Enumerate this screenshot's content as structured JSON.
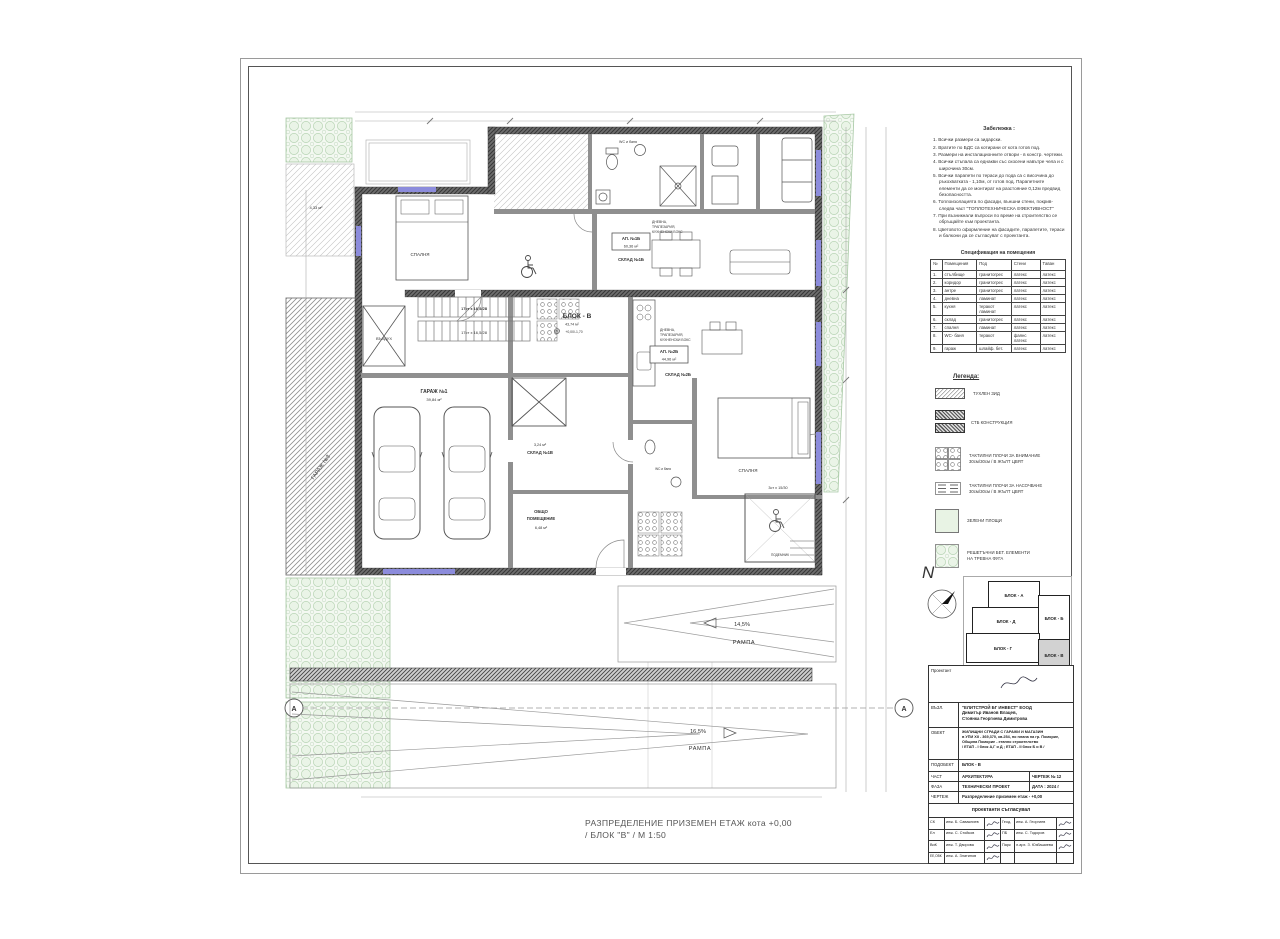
{
  "colors": {
    "wall_dark": "#5a5a5a",
    "window_blue": "#8c8cdc",
    "green_area": "#e8f3e4",
    "paper": "#ffffff"
  },
  "notes": {
    "title": "Забележка :",
    "items": [
      "1. Всички размери са зидарски.",
      "2. Вратите по БДС са котирани от кота готов под.",
      "3. Размери на инсталационните отвори - в констр. чертежи.",
      "4. Всички стъпала са еднакви със скосени навътре чела и с широчина 30см.",
      "5. Всички парапети по тераси до пода са с височина до ръкохватката - 1,10м, от готов под. Парапетните елементи да се монтират на разстояние 0,12м предвид безопасността.",
      "6. Топлоизолацията по фасади, външни стени, покрив- следва част \"ТОПЛОТЕХНИЧЕСКА ЕФЕКТИВНОСТ\"",
      "7. При възникнали въпроси по време на строителство се обръщайте към проектанта.",
      "8. Цветовото оформление на фасадите, парапетите, тераси и балкони да се съгласуват с проектанта."
    ]
  },
  "spec": {
    "title": "Спецификация на помещения",
    "headers": [
      "№",
      "Помещения",
      "Под",
      "Стени",
      "Таван"
    ],
    "rows": [
      [
        "1.",
        "стълбище",
        "гранитогрес",
        "латекс",
        "латекс"
      ],
      [
        "2.",
        "коридор",
        "гранитогрес",
        "латекс",
        "латекс"
      ],
      [
        "3.",
        "антре",
        "гранитогрес",
        "латекс",
        "латекс"
      ],
      [
        "4.",
        "дневна",
        "ламинат",
        "латекс",
        "латекс"
      ],
      [
        "5.",
        "кухня",
        "теракот\nламинат",
        "латекс",
        "латекс"
      ],
      [
        "6.",
        "склад",
        "гранитогрес",
        "латекс",
        "латекс"
      ],
      [
        "7.",
        "спалня",
        "ламинат",
        "латекс",
        "латекс"
      ],
      [
        "8.",
        "WC- баня",
        "теракот",
        "фаянс\nлатекс",
        "латекс"
      ],
      [
        "9.",
        "гараж",
        "шлайф. бет.",
        "латекс",
        "латекс"
      ]
    ]
  },
  "legend": {
    "title": "Легенда:",
    "items": [
      {
        "label": "ТУХЛЕН ЗИД"
      },
      {
        "label": "СТБ КОНСТРУКЦИЯ"
      },
      {
        "label": "ТАКТИЛНИ ПЛОЧИ ЗА ВНИМАНИЕ\n30см/30см / В ЖЪЛТ ЦВЯТ"
      },
      {
        "label": "ТАКТИЛНИ ПЛОЧИ ЗА НАСОЧВАНЕ\n30см/30см / В ЖЪЛТ ЦВЯТ"
      },
      {
        "label": "ЗЕЛЕНИ ПЛОЩИ"
      },
      {
        "label": "РЕШЕТЪЧНИ БЕТ. ЕЛЕМЕНТИ\nНА ТРЕВНА ФУГА"
      }
    ]
  },
  "key_plan": {
    "north": "N",
    "block_a": "БЛОК - А",
    "block_d": "БЛОК - Д",
    "block_b": "БЛОК - Б",
    "block_g": "БЛОК - Г",
    "block_v": "БЛОК - В"
  },
  "title_block": {
    "designer": "Проектант",
    "client_label": "ВЪЗЛ.",
    "client": "\"ЕЛИТСТРОЙ БГ ИНВЕСТ\" ЕООД\nДимитър Иванов Влацев,\nСтоянка Георгиева Димитрова",
    "object_label": "ОБЕКТ",
    "object": "ЖИЛИЩНИ СГРАДИ С ГАРАЖИ И МАГАЗИН\nв УПИ XII - 369,370, кв.254, по плана на гр. Поморие,\nОбщина Поморие - етапно строителство\n/ ЕТАП - I блок А,Г и Д ; ЕТАП - II блок Б и В /",
    "subobject_label": "ПОДОБЕКТ",
    "subobject": "БЛОК - В",
    "part_label": "ЧАСТ",
    "part": "АРХИТЕКТУРА",
    "sheet_no": "ЧЕРТЕЖ  № 12",
    "phase_label": "ФАЗА",
    "phase": "ТЕХНИЧЕСКИ ПРОЕКТ",
    "date": "ДАТА :  2024 г",
    "drawing_label": "ЧЕРТЕЖ",
    "drawing": "Разпределение  приземен етаж - +0,00",
    "sign_header": "проектанти съгласувал",
    "signers": [
      {
        "code": "СК",
        "name": "инж. Б. Саваклиев",
        "code2": "Геод.",
        "name2": "инж. А. Георгиев"
      },
      {
        "code": "Ел",
        "name": "инж. С. Стойков",
        "code2": "ПБ",
        "name2": "инж. С. Тодоров"
      },
      {
        "code": "ВиК",
        "name": "инж. Т. Дворова",
        "code2": "Парк",
        "name2": "л.арх. З. Юзбашиева"
      },
      {
        "code": "ЕЕ,ОВК",
        "name": "инж. А. Златинов",
        "code2": "",
        "name2": ""
      }
    ]
  },
  "plan": {
    "garage1_name": "ГАРАЖ №1",
    "garage1_area": "39,84 м²",
    "garage3": "ГАРАЖ №3",
    "ap1b_name": "АП. №1Б",
    "ap1b_area": "60,36 м²",
    "sklad1b": "СКЛАД №1Б",
    "ap2b_name": "АП. №2Б",
    "ap2b_area": "44,96 м²",
    "sklad2b": "СКЛАД №2Б",
    "sklad1v_name": "СКЛАД №1В",
    "sklad1v_area": "3,24 м²",
    "obshto_l1": "ОБЩО",
    "obshto_l2": "ПОМЕЩЕНИЕ",
    "obshto_area": "6,48 м²",
    "blok_name": "БЛОК - В",
    "blok_area": "43,74 м²",
    "blok_level": "+0,00/-1,70",
    "bedroom": "СПАЛНЯ",
    "wc": "WC и баня",
    "living_l1": "ДНЕВНА,",
    "living_l2": "ТРАПЕЗАРИЯ,",
    "living_l3": "КУХНЕНСКИ БОКС",
    "vazduh": "ВЪЗДУХ",
    "stairs17": "17ст х 16,5/28",
    "steps3": "3ст х 15/30",
    "podemnik": "ПОДЕМНИК",
    "ramp1_pct": "14,5%",
    "ramp2_pct": "16,5%",
    "ramp_word": "РАМПА",
    "terrace_area": "4,33 м²",
    "axis_a": "А"
  },
  "footer": {
    "title_line1": "РАЗПРЕДЕЛЕНИЕ ПРИЗЕМЕН ЕТАЖ  кота +0,00",
    "title_line2": "/ БЛОК \"В\" /  М 1:50"
  }
}
